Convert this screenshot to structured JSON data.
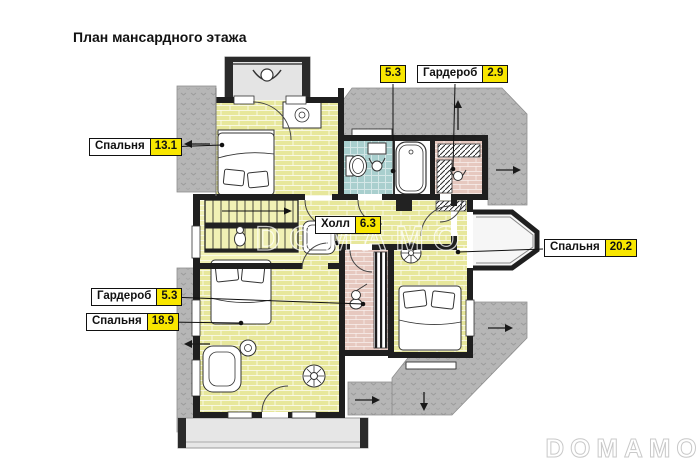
{
  "page": {
    "title": "План мансардного этажа"
  },
  "watermarks": {
    "center": "DOMAMO",
    "corner": "DOMAMO"
  },
  "labels": [
    {
      "id": "bedroom-13",
      "room": "Спальня",
      "area": "13.1"
    },
    {
      "id": "bathroom",
      "room": "",
      "area": "5.3"
    },
    {
      "id": "wardrobe-2-9",
      "room": "Гардероб",
      "area": "2.9"
    },
    {
      "id": "hall",
      "room": "Холл",
      "area": "6.3"
    },
    {
      "id": "bedroom-20",
      "room": "Спальня",
      "area": "20.2"
    },
    {
      "id": "wardrobe-5-3",
      "room": "Гардероб",
      "area": "5.3"
    },
    {
      "id": "bedroom-18",
      "room": "Спальня",
      "area": "18.9"
    }
  ],
  "legend_colors": {
    "bedroom_floor": "#e7e79b",
    "stair_floor": "#f1f1b5",
    "bathroom_floor": "#a9cfce",
    "wardrobe_floor": "#e6c8bf",
    "roof_area": "#b6b6b6",
    "label_highlight": "#f8e600",
    "walls": "#1f1f1f"
  },
  "icons": {
    "roof_slope_arrow_left": "←",
    "roof_slope_arrow_right": "→",
    "roof_slope_arrow_up": "↑",
    "roof_slope_arrow_down": "↓"
  }
}
